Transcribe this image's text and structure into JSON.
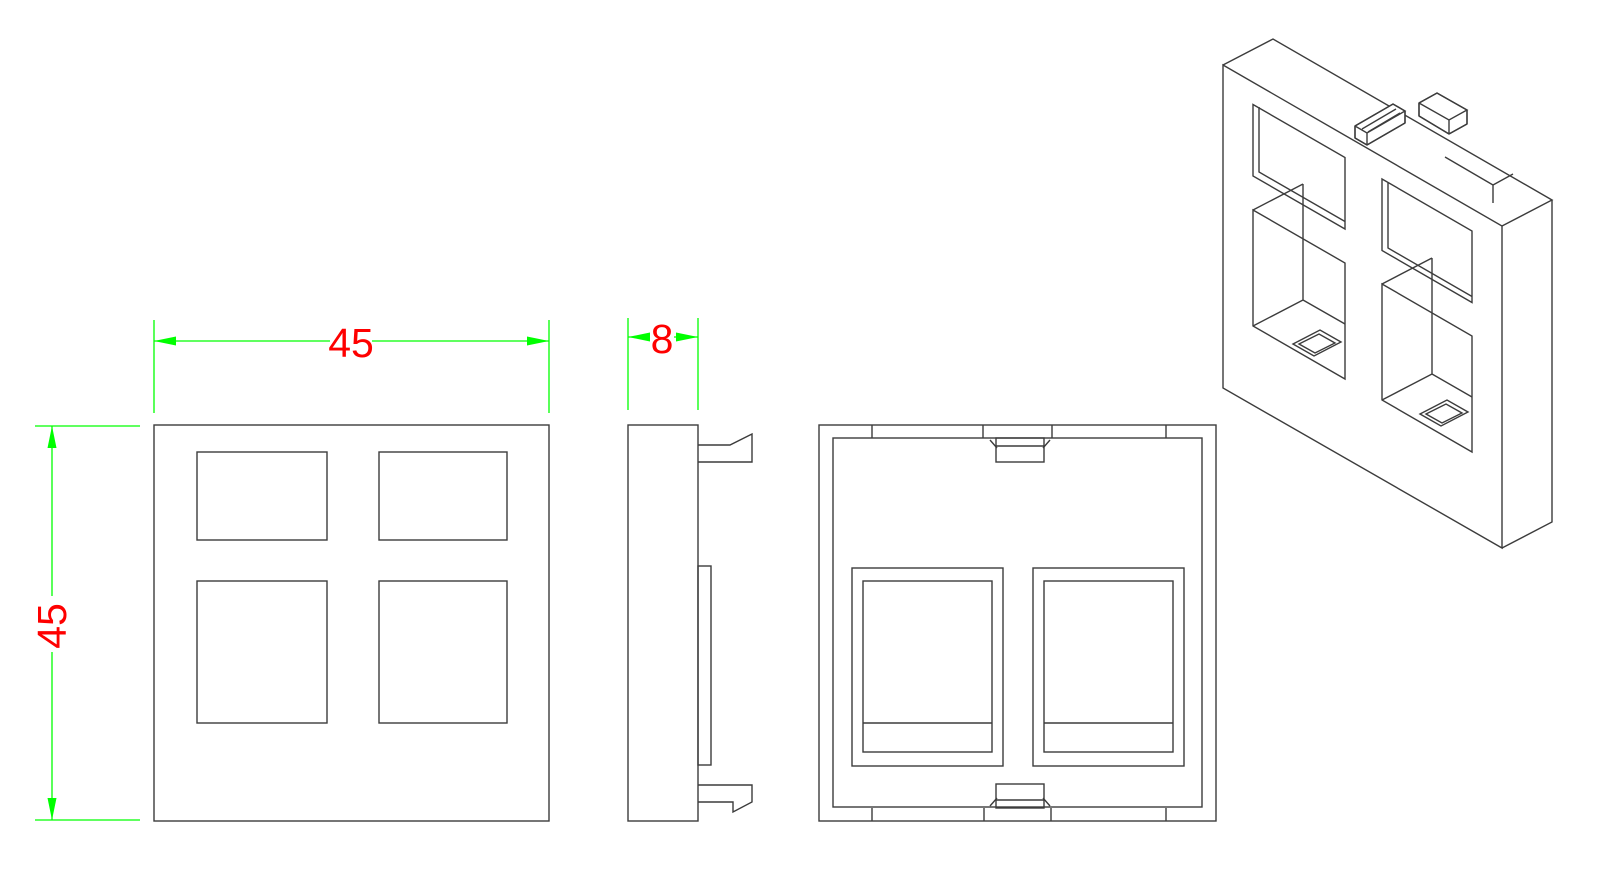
{
  "drawing": {
    "kind": "cad-technical-drawing",
    "part": "45x45 faceplate with four ports, thickness 8"
  },
  "dimensions": {
    "width": {
      "value": "45"
    },
    "height": {
      "value": "45"
    },
    "thickness": {
      "value": "8"
    }
  },
  "colors": {
    "geometry_line": "#3c3c3c",
    "dimension": "#00e000",
    "dimension_bright": "#00ff00",
    "label_text": "#fe0000",
    "background": "#ffffff"
  }
}
